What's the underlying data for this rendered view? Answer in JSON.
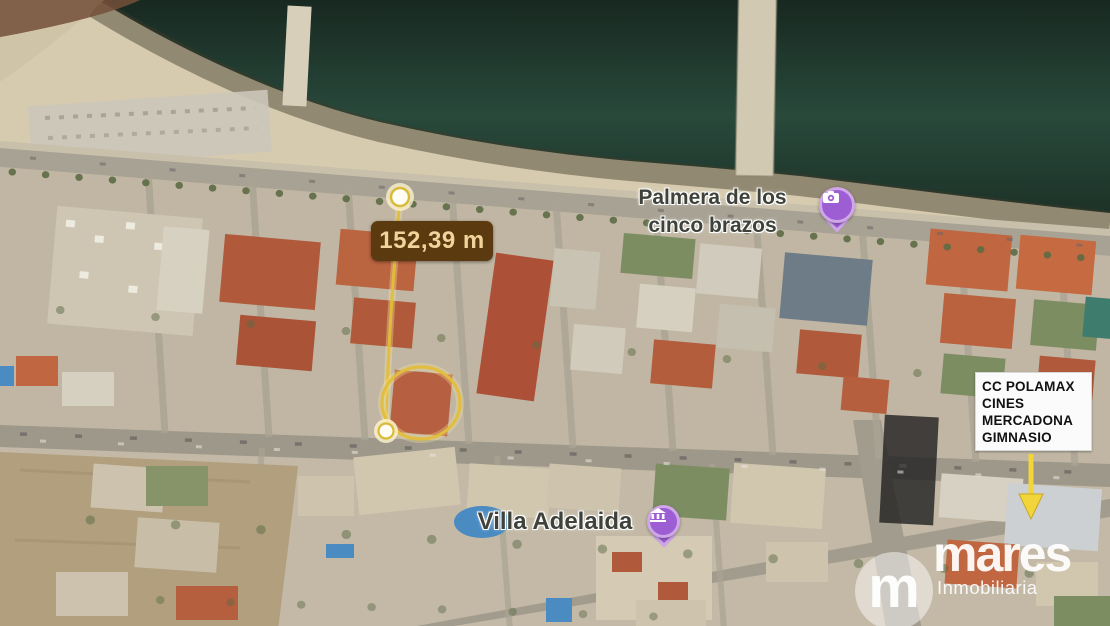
{
  "measurement": {
    "value": "152,39 m"
  },
  "places": {
    "palmera": {
      "line1": "Palmera de los",
      "line2": "cinco brazos"
    },
    "villa": {
      "name": "Villa Adelaida"
    }
  },
  "info_box": {
    "lines": [
      "CC POLAMAX",
      "CINES",
      "MERCADONA",
      "GIMNASIO"
    ]
  },
  "watermark": {
    "monogram": "m",
    "name": "mares",
    "tagline": "Inmobiliaria"
  },
  "colors": {
    "annotation_yellow": "#e3bd3b",
    "measure_label_bg": "#5c3a10",
    "measure_label_text": "#f0d49c",
    "pin_purple": "#9c5ed2",
    "water_dark_green": "#27483a",
    "info_box_bg": "#fbfbfb",
    "info_box_text": "#111111",
    "watermark_white": "#ffffff"
  }
}
